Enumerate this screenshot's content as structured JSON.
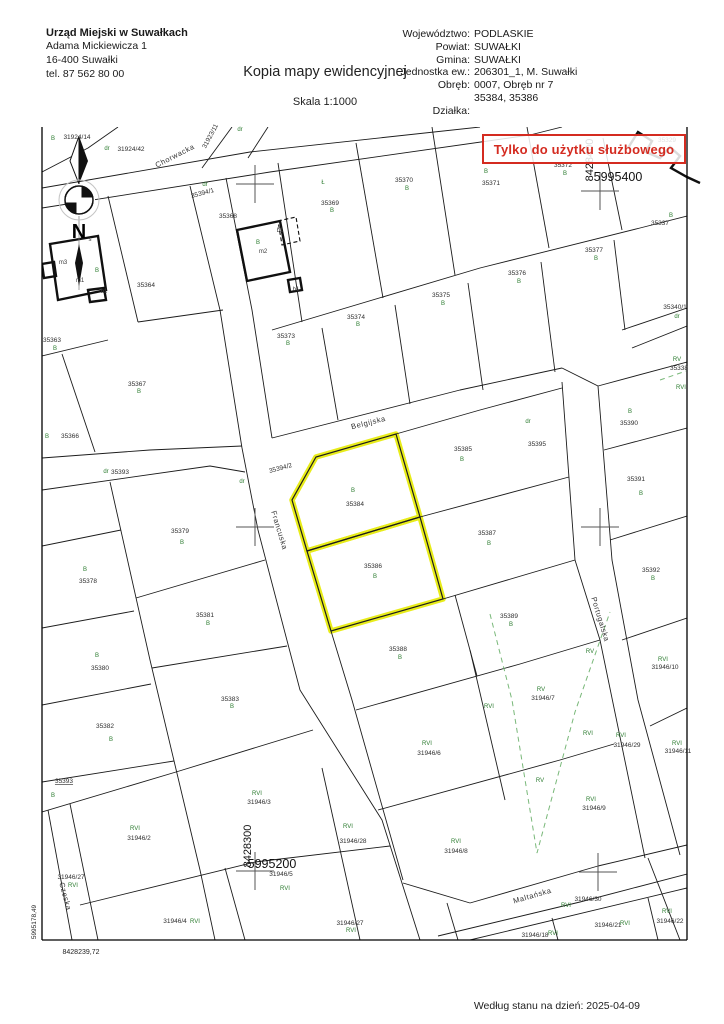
{
  "header": {
    "office": {
      "name": "Urząd Miejski w Suwałkach",
      "address_line1": "Adama Mickiewicza 1",
      "address_line2": "16-400 Suwałki",
      "phone": "tel. 87 562 80 00"
    },
    "title": "Kopia mapy ewidencyjnej",
    "scale": "Skala 1:1000",
    "right_rows": [
      {
        "label": "Województwo:",
        "value": "PODLASKIE"
      },
      {
        "label": "Powiat:",
        "value": "SUWAŁKI"
      },
      {
        "label": "Gmina:",
        "value": "SUWAŁKI"
      },
      {
        "label": "Jednostka ew.:",
        "value": "206301_1, M. Suwałki"
      },
      {
        "label": "Obręb:",
        "value": "0007, Obręb nr 7"
      },
      {
        "label": "",
        "value": "35384, 35386"
      },
      {
        "label": "Działka:",
        "value": ""
      }
    ]
  },
  "stamp": {
    "text": "Tylko do użytku służbowego",
    "color": "#d42b20"
  },
  "footer": {
    "status_text": "Według stanu na dzień: 2025-04-09"
  },
  "map": {
    "highlighted_parcels": [
      "35384",
      "35386"
    ],
    "highlight_color": "#e8ec1a",
    "class_label_color": "#2e7d32",
    "grid_crosses": [
      [
        255,
        184
      ],
      [
        600,
        191
      ],
      [
        255,
        527
      ],
      [
        600,
        527
      ],
      [
        255,
        871
      ],
      [
        598,
        872
      ]
    ],
    "labels": [
      [
        "Chorwacka",
        176,
        158,
        "s",
        -27
      ],
      [
        "Belgijska",
        369,
        425,
        "s",
        -14
      ],
      [
        "Francuska",
        277,
        531,
        "s",
        73
      ],
      [
        "Portugalska",
        598,
        620,
        "s",
        73
      ],
      [
        "Czeska",
        63,
        897,
        "s",
        75
      ],
      [
        "Maltańska",
        533,
        898,
        "s",
        -16
      ],
      [
        "5995400",
        618,
        181,
        "c",
        0
      ],
      [
        "8428400",
        593,
        160,
        "cv",
        0
      ],
      [
        "5995200",
        272,
        868,
        "c",
        0
      ],
      [
        "8428300",
        251,
        846,
        "cv",
        0
      ],
      [
        "5995178,49",
        36,
        922,
        "csv",
        0
      ],
      [
        "8428239,72",
        81,
        954,
        "cs",
        0
      ],
      [
        "N",
        79,
        238,
        "n",
        0
      ],
      [
        "s",
        90,
        241,
        "b",
        0
      ],
      [
        "B",
        53,
        140,
        "g",
        0
      ],
      [
        "31924/14",
        77,
        139,
        "p",
        0
      ],
      [
        "dr",
        107,
        150,
        "g",
        0
      ],
      [
        "31924/42",
        131,
        151,
        "p",
        0
      ],
      [
        "31923/11",
        212,
        137,
        "p",
        -62
      ],
      [
        "dr",
        240,
        131,
        "g",
        0
      ],
      [
        "dr",
        205,
        186,
        "g",
        0
      ],
      [
        "35394/1",
        203,
        195,
        "p",
        -15
      ],
      [
        "35364",
        146,
        287,
        "p",
        0
      ],
      [
        "B",
        97,
        272,
        "g",
        0
      ],
      [
        "m3",
        63,
        264,
        "b",
        0
      ],
      [
        "m1",
        80,
        282,
        "b",
        0
      ],
      [
        "b1",
        104,
        293,
        "b",
        0
      ],
      [
        "35368",
        228,
        218,
        "p",
        0
      ],
      [
        "B",
        258,
        244,
        "g",
        0
      ],
      [
        "m2",
        263,
        253,
        "b",
        0
      ],
      [
        "b1",
        280,
        232,
        "b",
        0
      ],
      [
        "b1",
        296,
        291,
        "b",
        0
      ],
      [
        "Ł",
        323,
        184,
        "g",
        0
      ],
      [
        "35369",
        330,
        205,
        "p",
        0
      ],
      [
        "B",
        332,
        212,
        "g",
        0
      ],
      [
        "35370",
        404,
        182,
        "p",
        0
      ],
      [
        "B",
        407,
        190,
        "g",
        0
      ],
      [
        "B",
        486,
        173,
        "g",
        0
      ],
      [
        "35371",
        491,
        185,
        "p",
        0
      ],
      [
        "35372",
        563,
        167,
        "p",
        0
      ],
      [
        "B",
        565,
        175,
        "g",
        0
      ],
      [
        "35329",
        667,
        142,
        "p",
        0
      ],
      [
        "B",
        671,
        217,
        "g",
        0
      ],
      [
        "35337",
        660,
        225,
        "p",
        0
      ],
      [
        "35373",
        286,
        338,
        "p",
        0
      ],
      [
        "B",
        288,
        345,
        "g",
        0
      ],
      [
        "35374",
        356,
        319,
        "p",
        0
      ],
      [
        "B",
        358,
        326,
        "g",
        0
      ],
      [
        "35375",
        441,
        297,
        "p",
        0
      ],
      [
        "B",
        443,
        305,
        "g",
        0
      ],
      [
        "35376",
        517,
        275,
        "p",
        0
      ],
      [
        "B",
        519,
        283,
        "g",
        0
      ],
      [
        "35377",
        594,
        252,
        "p",
        0
      ],
      [
        "B",
        596,
        260,
        "g",
        0
      ],
      [
        "35340/1",
        675,
        309,
        "p",
        0
      ],
      [
        "dr",
        677,
        318,
        "g",
        0
      ],
      [
        "RV",
        677,
        361,
        "g",
        0
      ],
      [
        "35338",
        679,
        370,
        "p",
        0
      ],
      [
        "RVI",
        681,
        389,
        "g",
        0
      ],
      [
        "35363",
        52,
        342,
        "p",
        0
      ],
      [
        "B",
        55,
        350,
        "g",
        0
      ],
      [
        "35367",
        137,
        386,
        "p",
        0
      ],
      [
        "B",
        139,
        393,
        "g",
        0
      ],
      [
        "B",
        47,
        438,
        "g",
        0
      ],
      [
        "35366",
        70,
        438,
        "p",
        0
      ],
      [
        "dr",
        106,
        473,
        "g",
        0
      ],
      [
        "35393",
        120,
        474,
        "p",
        0
      ],
      [
        "B",
        85,
        571,
        "g",
        0
      ],
      [
        "35378",
        88,
        583,
        "p",
        0
      ],
      [
        "B",
        97,
        657,
        "g",
        0
      ],
      [
        "35380",
        100,
        670,
        "p",
        0
      ],
      [
        "35382",
        105,
        728,
        "p",
        0
      ],
      [
        "B",
        111,
        741,
        "g",
        0
      ],
      [
        "35393",
        64,
        783,
        "pu",
        0
      ],
      [
        "B",
        53,
        797,
        "g",
        0
      ],
      [
        "35394/2",
        281,
        470,
        "p",
        -15
      ],
      [
        "dr",
        242,
        483,
        "g",
        0
      ],
      [
        "B",
        353,
        492,
        "g",
        0
      ],
      [
        "35384",
        355,
        506,
        "p",
        0
      ],
      [
        "35386",
        373,
        568,
        "p",
        0
      ],
      [
        "B",
        375,
        578,
        "g",
        0
      ],
      [
        "35379",
        180,
        533,
        "p",
        0
      ],
      [
        "B",
        182,
        544,
        "g",
        0
      ],
      [
        "35381",
        205,
        617,
        "p",
        0
      ],
      [
        "B",
        208,
        625,
        "g",
        0
      ],
      [
        "35383",
        230,
        701,
        "p",
        0
      ],
      [
        "B",
        232,
        708,
        "g",
        0
      ],
      [
        "35385",
        463,
        451,
        "p",
        0
      ],
      [
        "B",
        462,
        461,
        "g",
        0
      ],
      [
        "35387",
        487,
        535,
        "p",
        0
      ],
      [
        "B",
        489,
        545,
        "g",
        0
      ],
      [
        "dr",
        528,
        423,
        "g",
        0
      ],
      [
        "35395",
        537,
        446,
        "p",
        0
      ],
      [
        "B",
        630,
        413,
        "g",
        0
      ],
      [
        "35390",
        629,
        425,
        "p",
        0
      ],
      [
        "35391",
        636,
        481,
        "p",
        0
      ],
      [
        "B",
        641,
        495,
        "g",
        0
      ],
      [
        "35392",
        651,
        572,
        "p",
        0
      ],
      [
        "B",
        653,
        580,
        "g",
        0
      ],
      [
        "35389",
        509,
        618,
        "p",
        0
      ],
      [
        "B",
        511,
        626,
        "g",
        0
      ],
      [
        "35388",
        398,
        651,
        "p",
        0
      ],
      [
        "B",
        400,
        659,
        "g",
        0
      ],
      [
        "RVI",
        135,
        830,
        "g",
        0
      ],
      [
        "31946/2",
        139,
        840,
        "p",
        0
      ],
      [
        "RVI",
        257,
        795,
        "g",
        0
      ],
      [
        "31946/3",
        259,
        804,
        "p",
        0
      ],
      [
        "31946/27",
        71,
        879,
        "p",
        0
      ],
      [
        "RVI",
        73,
        887,
        "g",
        0
      ],
      [
        "31946/5",
        281,
        876,
        "p",
        0
      ],
      [
        "RVI",
        285,
        890,
        "g",
        0
      ],
      [
        "31946/4",
        175,
        923,
        "p",
        0
      ],
      [
        "RVI",
        195,
        923,
        "g",
        0
      ],
      [
        "RV",
        541,
        691,
        "g",
        0
      ],
      [
        "31946/7",
        543,
        700,
        "p",
        0
      ],
      [
        "RVI",
        489,
        708,
        "g",
        0
      ],
      [
        "RVI",
        588,
        735,
        "g",
        0
      ],
      [
        "RVI",
        427,
        745,
        "g",
        0
      ],
      [
        "31946/6",
        429,
        755,
        "p",
        0
      ],
      [
        "RV",
        540,
        782,
        "g",
        0
      ],
      [
        "RVI",
        591,
        801,
        "g",
        0
      ],
      [
        "31946/9",
        594,
        810,
        "p",
        0
      ],
      [
        "RVI",
        456,
        843,
        "g",
        0
      ],
      [
        "31946/8",
        456,
        853,
        "p",
        0
      ],
      [
        "RVI",
        348,
        828,
        "g",
        0
      ],
      [
        "31946/28",
        353,
        843,
        "p",
        0
      ],
      [
        "31946/27",
        350,
        925,
        "p",
        0
      ],
      [
        "RVI",
        351,
        932,
        "g",
        0
      ],
      [
        "RVI",
        663,
        661,
        "g",
        0
      ],
      [
        "31946/10",
        665,
        669,
        "p",
        0
      ],
      [
        "RVI",
        621,
        737,
        "g",
        0
      ],
      [
        "31946/29",
        627,
        747,
        "p",
        0
      ],
      [
        "RVI",
        677,
        745,
        "g",
        0
      ],
      [
        "31946/11",
        678,
        753,
        "p",
        0
      ],
      [
        "RV",
        590,
        653,
        "g",
        0
      ],
      [
        "31946/30",
        588,
        901,
        "p",
        0
      ],
      [
        "RVI",
        566,
        907,
        "g",
        0
      ],
      [
        "31946/21",
        608,
        927,
        "p",
        0
      ],
      [
        "RVI",
        625,
        925,
        "g",
        0
      ],
      [
        "RVI",
        667,
        913,
        "g",
        0
      ],
      [
        "31946/22",
        670,
        923,
        "p",
        0
      ],
      [
        "31946/18",
        535,
        937,
        "p",
        0
      ],
      [
        "RVI",
        553,
        935,
        "g",
        0
      ]
    ]
  }
}
